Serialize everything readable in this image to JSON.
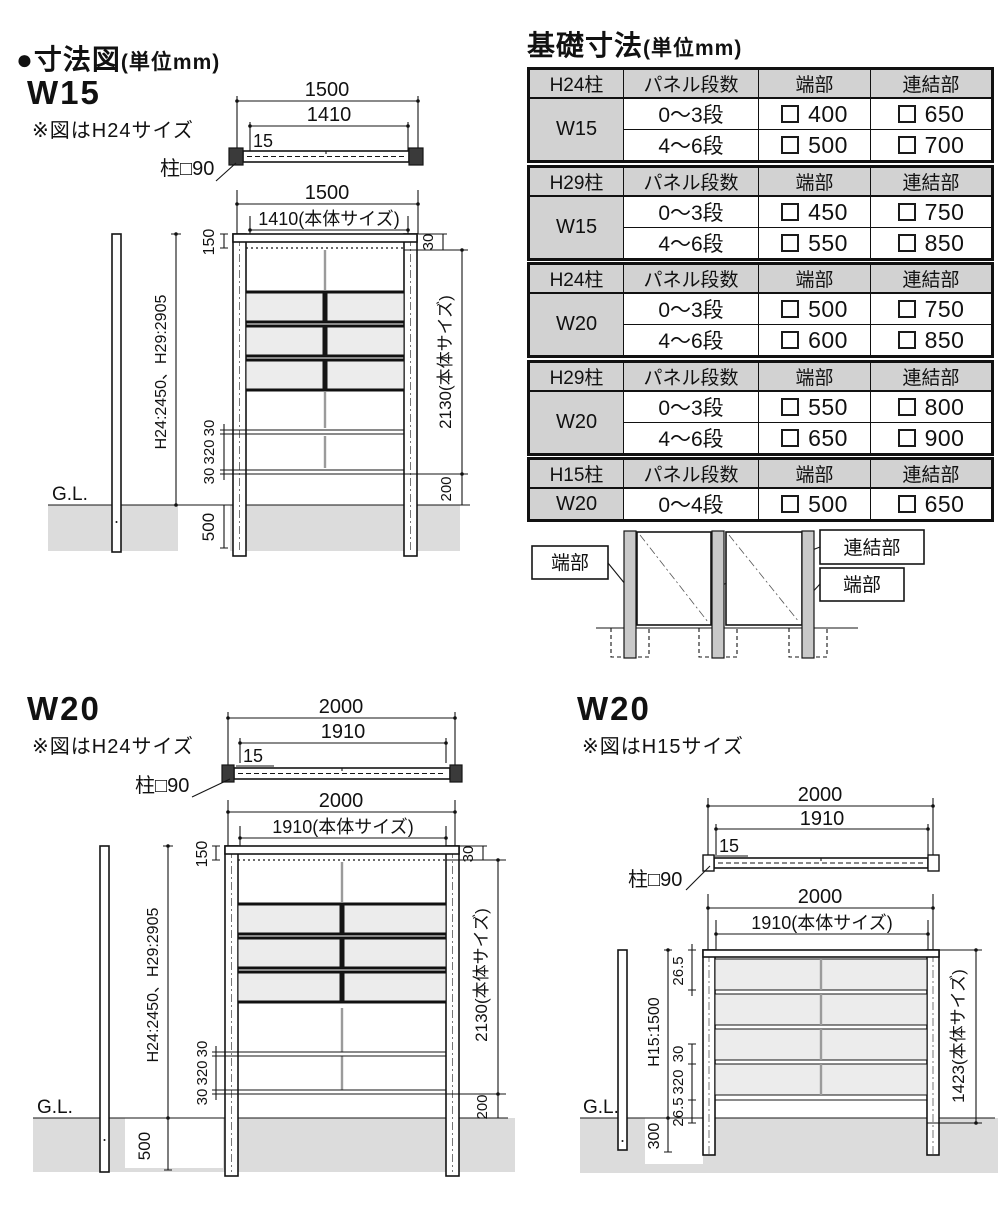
{
  "hl": {
    "title": "●寸法図",
    "unit": "(単位mm)"
  },
  "hr": {
    "title": "基礎寸法",
    "unit": "(単位mm)"
  },
  "w15": {
    "label": "W15",
    "note": "※図はH24サイズ",
    "top": {
      "overall": "1500",
      "inner": "1410",
      "offset": "15",
      "post": "柱□90"
    },
    "front": {
      "overall": "1500",
      "inner": "1410(本体サイズ)",
      "top_offset": "150",
      "post_height": "H24:2450、H29:2905",
      "top_gap": "30",
      "body_height": "2130(本体サイズ)",
      "rail_a": "30",
      "rail_gap": "320",
      "rail_b": "30",
      "embed": "500",
      "clearance": "200",
      "gl": "G.L."
    }
  },
  "w20h24": {
    "label": "W20",
    "note": "※図はH24サイズ",
    "top": {
      "overall": "2000",
      "inner": "1910",
      "offset": "15",
      "post": "柱□90"
    },
    "front": {
      "overall": "2000",
      "inner": "1910(本体サイズ)",
      "top_offset": "150",
      "post_height": "H24:2450、H29:2905",
      "top_gap": "30",
      "body_height": "2130(本体サイズ)",
      "rail_a": "30",
      "rail_gap": "320",
      "rail_b": "30",
      "embed": "500",
      "clearance": "200",
      "gl": "G.L."
    }
  },
  "w20h15": {
    "label": "W20",
    "note": "※図はH15サイズ",
    "top": {
      "overall": "2000",
      "inner": "1910",
      "offset": "15",
      "post": "柱□90"
    },
    "front": {
      "overall": "2000",
      "inner": "1910(本体サイズ)",
      "top_offset": "26.5",
      "post_height": "H15:1500",
      "rail_a": "30",
      "rail_gap": "320",
      "rail_b": "26.5",
      "embed": "300",
      "body_height": "1423(本体サイズ)",
      "gl": "G.L."
    }
  },
  "tables": [
    {
      "post": "H24柱",
      "col_steps": "パネル段数",
      "col_end": "端部",
      "col_joint": "連結部",
      "size": "W15",
      "rows": [
        {
          "steps": "0〜3段",
          "end": "400",
          "joint": "650"
        },
        {
          "steps": "4〜6段",
          "end": "500",
          "joint": "700"
        }
      ]
    },
    {
      "post": "H29柱",
      "col_steps": "パネル段数",
      "col_end": "端部",
      "col_joint": "連結部",
      "size": "W15",
      "rows": [
        {
          "steps": "0〜3段",
          "end": "450",
          "joint": "750"
        },
        {
          "steps": "4〜6段",
          "end": "550",
          "joint": "850"
        }
      ]
    },
    {
      "post": "H24柱",
      "col_steps": "パネル段数",
      "col_end": "端部",
      "col_joint": "連結部",
      "size": "W20",
      "rows": [
        {
          "steps": "0〜3段",
          "end": "500",
          "joint": "750"
        },
        {
          "steps": "4〜6段",
          "end": "600",
          "joint": "850"
        }
      ]
    },
    {
      "post": "H29柱",
      "col_steps": "パネル段数",
      "col_end": "端部",
      "col_joint": "連結部",
      "size": "W20",
      "rows": [
        {
          "steps": "0〜3段",
          "end": "550",
          "joint": "800"
        },
        {
          "steps": "4〜6段",
          "end": "650",
          "joint": "900"
        }
      ]
    },
    {
      "post": "H15柱",
      "col_steps": "パネル段数",
      "col_end": "端部",
      "col_joint": "連結部",
      "size": "W20",
      "rows": [
        {
          "steps": "0〜4段",
          "end": "500",
          "joint": "650"
        }
      ]
    }
  ],
  "legend": {
    "end_left": "端部",
    "joint": "連結部",
    "end_right": "端部"
  }
}
